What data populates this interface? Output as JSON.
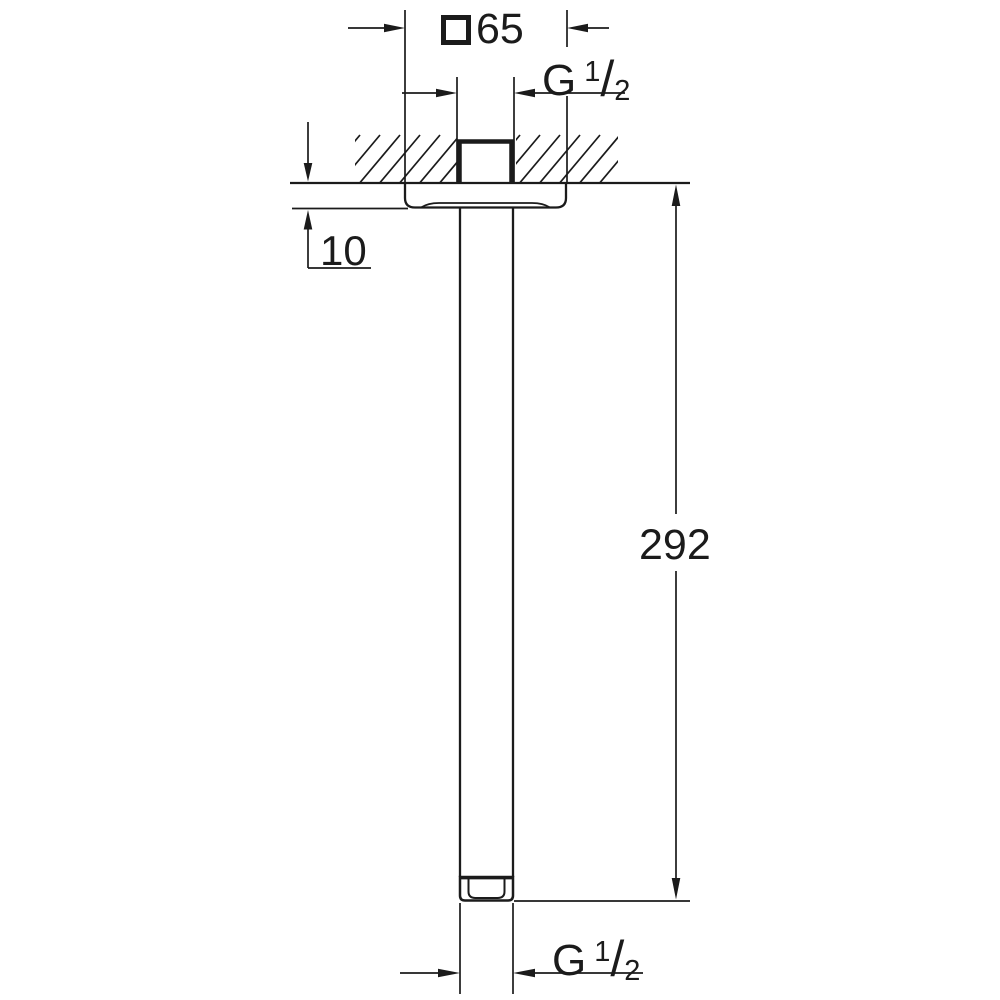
{
  "drawing": {
    "flange_width": {
      "value": "65"
    },
    "thread_top": {
      "base": "G",
      "sup": "1",
      "slash": "/",
      "sub": "2"
    },
    "flange_thickness": {
      "value": "10"
    },
    "arm_length": {
      "value": "292"
    },
    "thread_bottom": {
      "base": "G",
      "sup": "1",
      "slash": "/",
      "sub": "2"
    }
  },
  "colors": {
    "line": "#1b1b1b",
    "background": "#ffffff"
  }
}
